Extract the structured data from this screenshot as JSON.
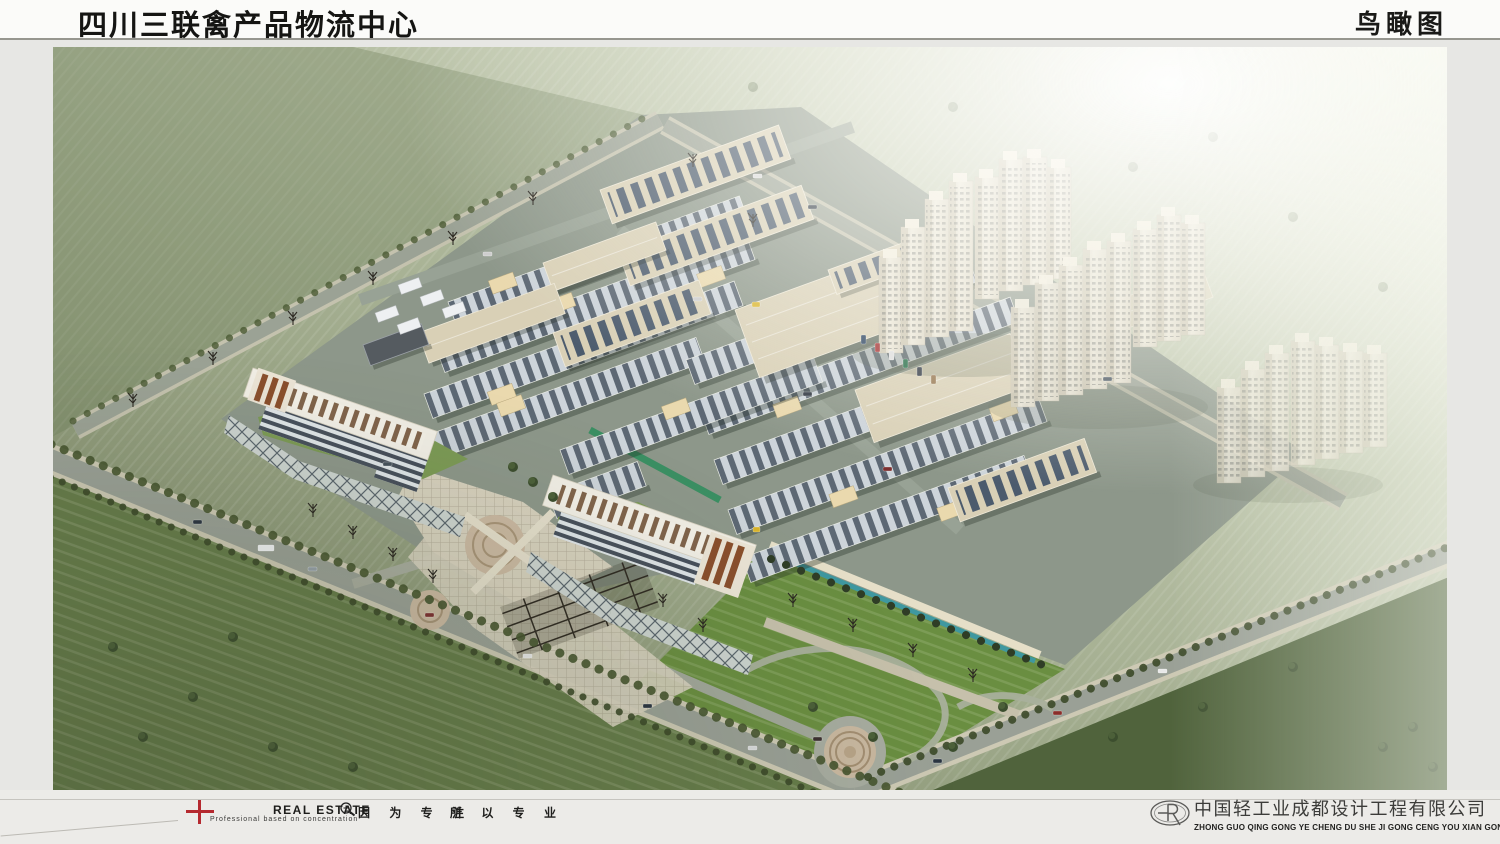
{
  "header": {
    "title": "四川三联禽产品物流中心",
    "view_label": "鸟瞰图"
  },
  "footer": {
    "tagline_en": "Professional  based on  concentration",
    "brand": "REAL ESTATE",
    "slogan_left": "因 为 专 注",
    "slogan_right": "所 以 专 业",
    "company_name": "中国轻工业成都设计工程有限公司",
    "company_pinyin": "ZHONG GUO QING GONG YE CHENG DU SHE JI GONG CENG YOU XIAN GONG SI"
  },
  "palette": {
    "brand_red": "#b5292f",
    "mist_green": "#9aa586",
    "lawn_green": "#6f9440",
    "warehouse_beige": "#d9d0b6",
    "shed_roof_dark": "#5d6874",
    "office_brown": "#8a4f2c",
    "water_teal": "#3f98a0"
  }
}
